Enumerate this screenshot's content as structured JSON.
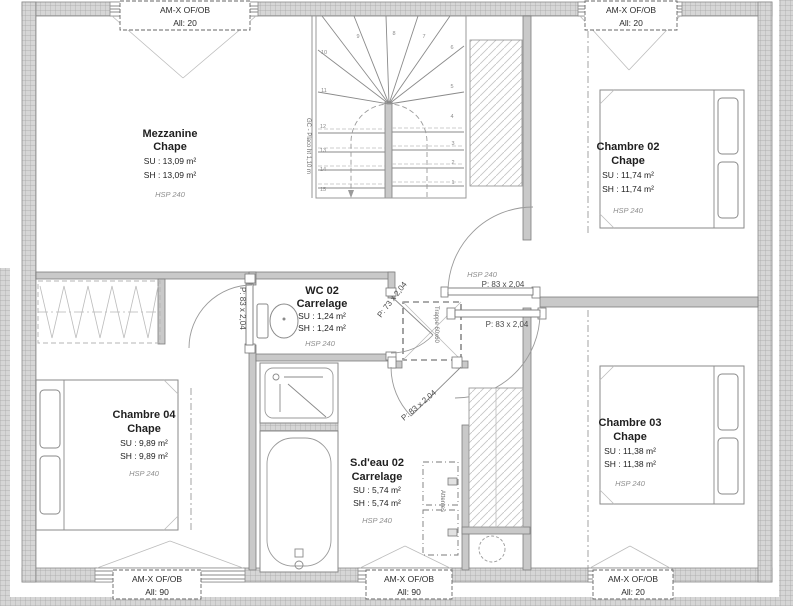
{
  "colors": {
    "wall_fill": "#d6d6d6",
    "wall_grid_line": "#a6a6a6",
    "partition_fill": "#c9c9c9",
    "linework": "#8a8a8a",
    "text": "#1f1f1f",
    "hsp_text": "#8f8f8f"
  },
  "windows": {
    "top_left": {
      "line1": "AM-X OF/OB",
      "line2": "All: 20"
    },
    "top_right": {
      "line1": "AM-X OF/OB",
      "line2": "All: 20"
    },
    "bottom_left": {
      "line1": "AM-X OF/OB",
      "line2": "All: 90"
    },
    "bottom_middle": {
      "line1": "AM-X OF/OB",
      "line2": "All: 90"
    },
    "bottom_right": {
      "line1": "AM-X OF/OB",
      "line2": "All: 20"
    }
  },
  "rooms": {
    "mezzanine": {
      "name": "Mezzanine",
      "finish": "Chape",
      "su": "SU : 13,09 m²",
      "sh": "SH : 13,09 m²",
      "hsp": "HSP 240"
    },
    "chambre02": {
      "name": "Chambre 02",
      "finish": "Chape",
      "su": "SU : 11,74 m²",
      "sh": "SH : 11,74 m²",
      "hsp": "HSP 240"
    },
    "wc02": {
      "name": "WC 02",
      "finish": "Carrelage",
      "su": "SU : 1,24 m²",
      "sh": "SH : 1,24 m²",
      "hsp": "HSP 240"
    },
    "chambre04": {
      "name": "Chambre 04",
      "finish": "Chape",
      "su": "SU : 9,89 m²",
      "sh": "SH : 9,89 m²",
      "hsp": "HSP 240"
    },
    "sdeau02": {
      "name": "S.d'eau 02",
      "finish": "Carrelage",
      "su": "SU : 5,74 m²",
      "sh": "SH : 5,74 m²",
      "hsp": "HSP 240"
    },
    "chambre03": {
      "name": "Chambre 03",
      "finish": "Chape",
      "su": "SU : 11,38 m²",
      "sh": "SH : 11,38 m²",
      "hsp": "HSP 240"
    }
  },
  "palier": {
    "hsp": "HSP 240"
  },
  "doors": {
    "chambre04_door": "P: 83 x 2,04",
    "wc_door": "P: 73 x 2,04",
    "sdeau_door": "P: 83 x 2,04",
    "chambre02_door": "P: 83 x 2,04",
    "chambre03_door": "P: 83 x 2,04"
  },
  "stairs": {
    "guardrail_label": "GC - Placo ht 1,10 m",
    "steps": [
      "1",
      "2",
      "3",
      "4",
      "5",
      "6",
      "7",
      "8",
      "9",
      "10",
      "11",
      "12",
      "13",
      "14",
      "15"
    ]
  },
  "annotations": {
    "trappe": "Trappe 60x60",
    "attentes": "Attentes"
  }
}
